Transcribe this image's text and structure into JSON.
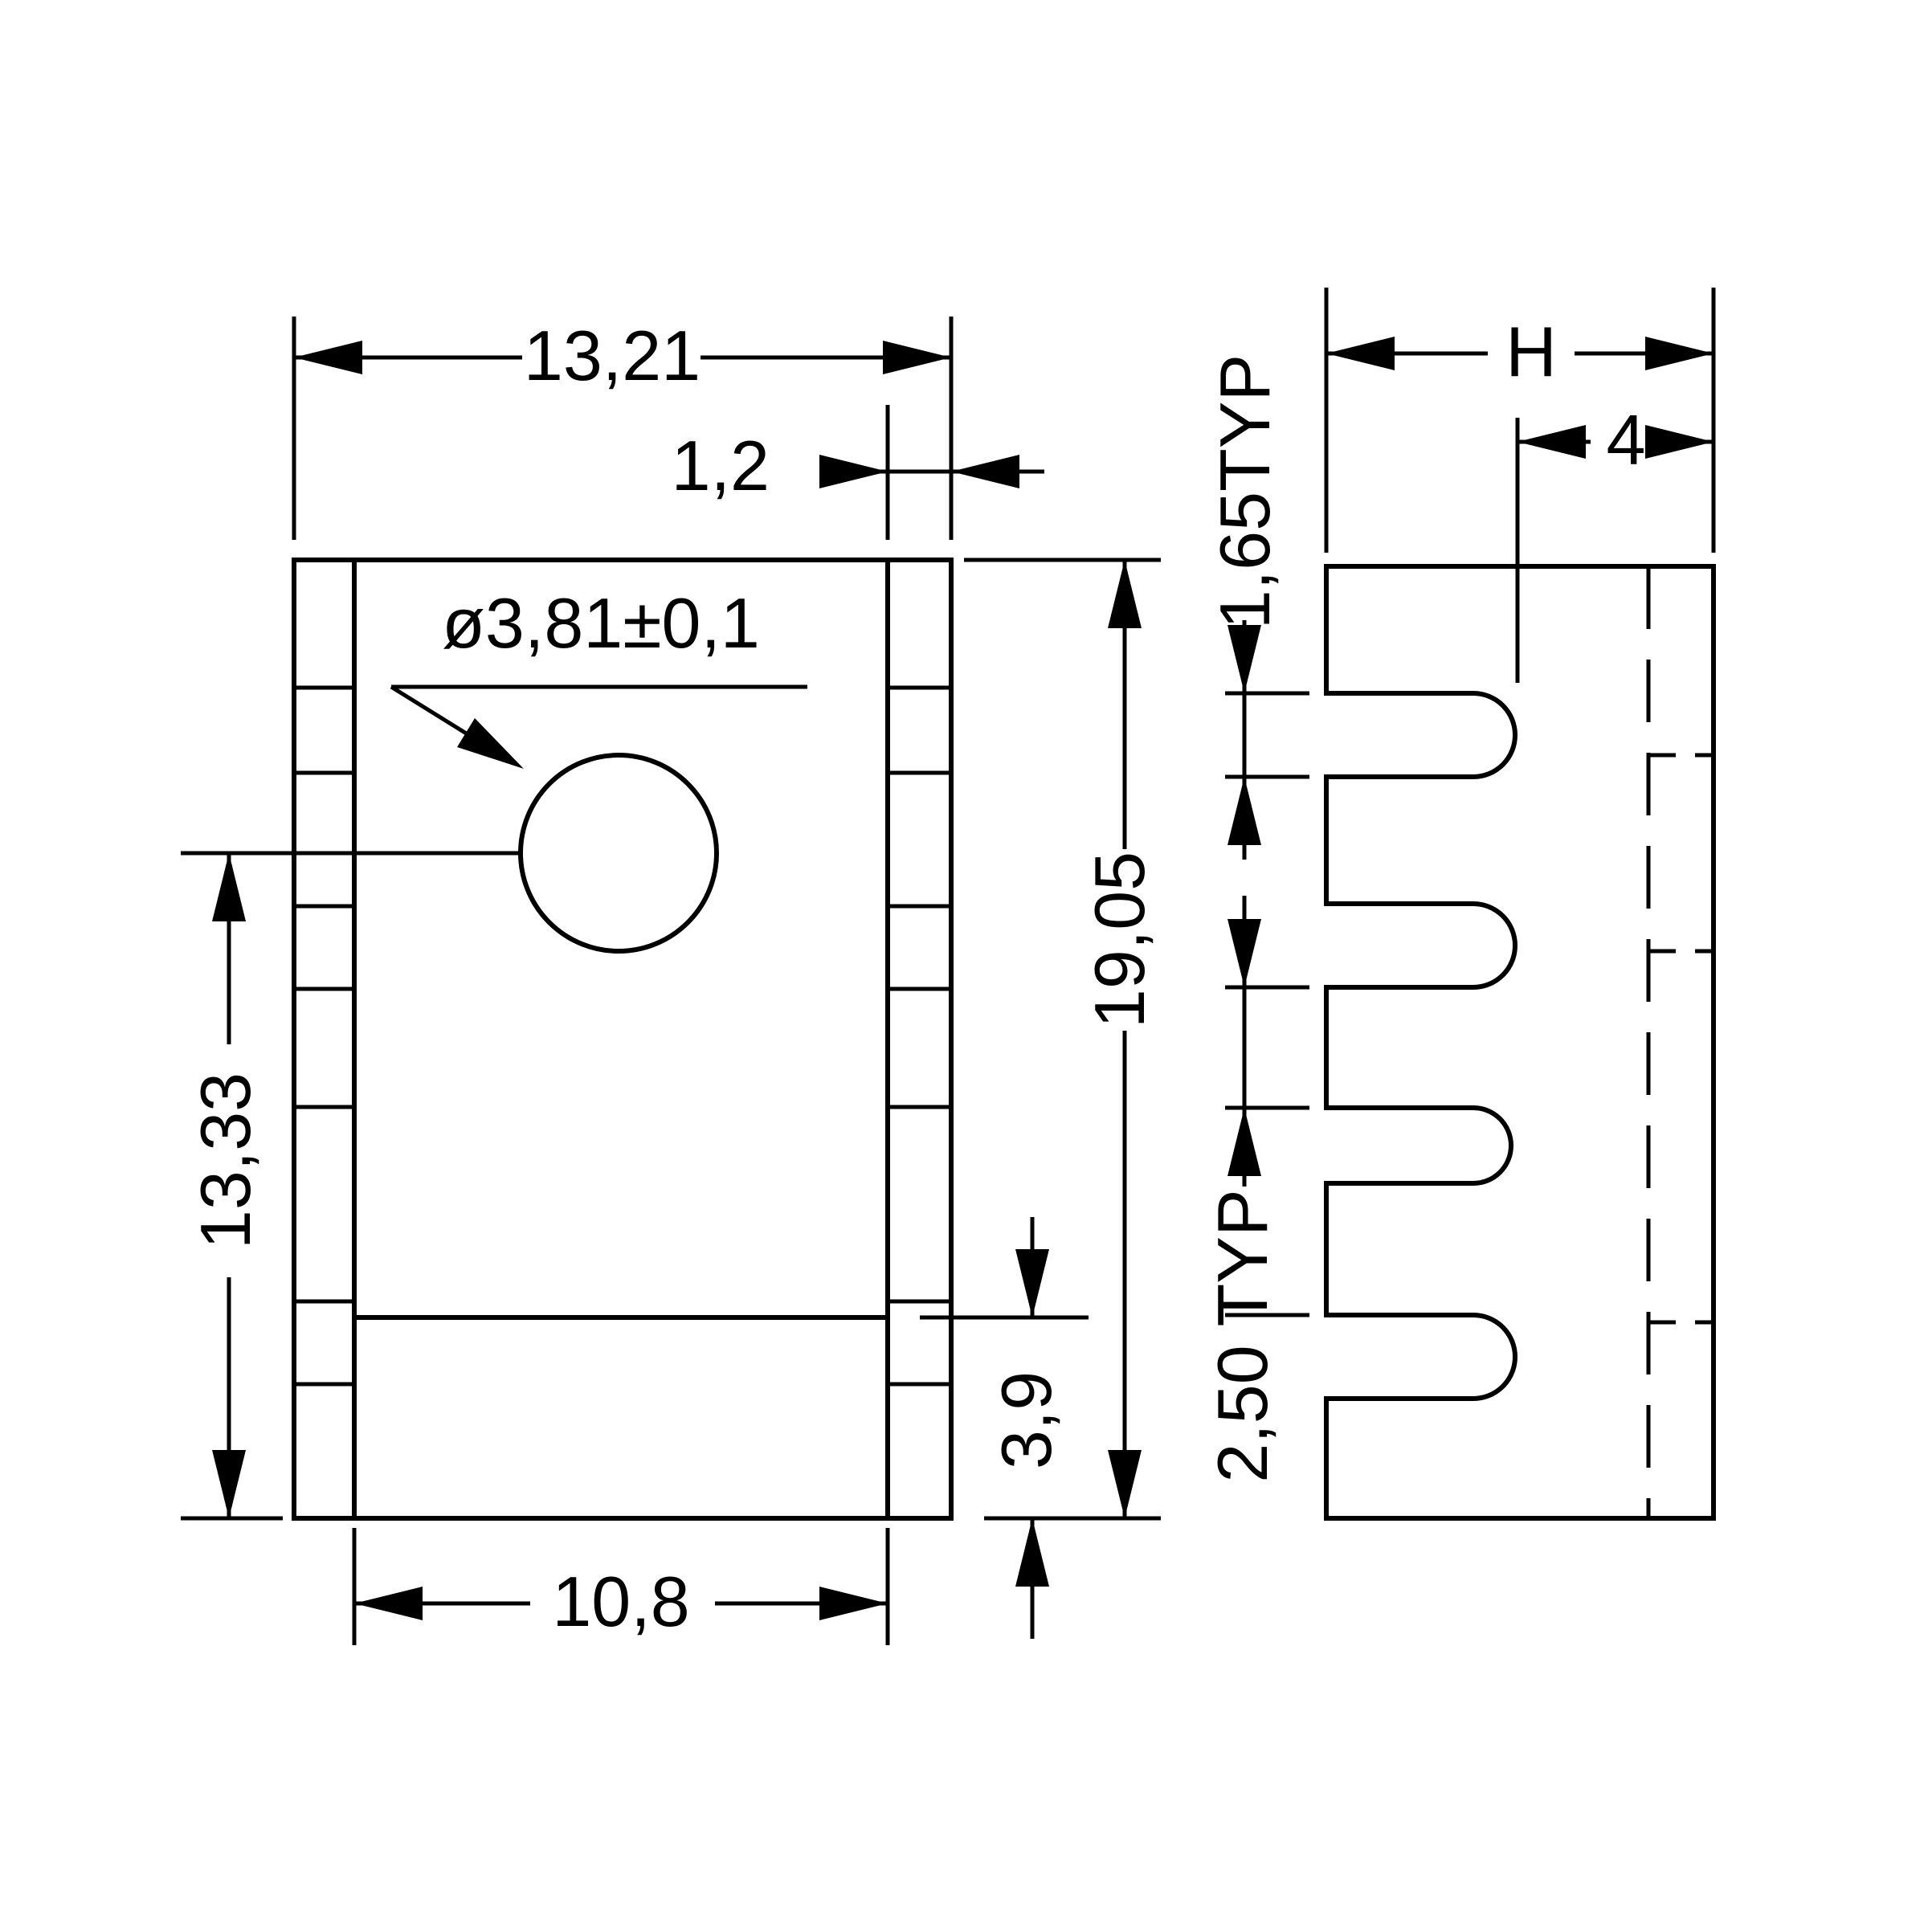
{
  "drawing": {
    "background": "#ffffff",
    "line_color": "#000000",
    "type": "technical-drawing-heatsink",
    "front_view": {
      "dim_width_top": "13,21",
      "dim_plate_thickness": "1,2",
      "hole_callout": "ø3,81±0,1",
      "dim_center_to_bottom": "13,33",
      "dim_total_height": "19,05",
      "dim_step_height": "3,9",
      "dim_width_bottom": "10,8"
    },
    "side_view": {
      "dim_depth": "H",
      "dim_tab_depth": "4",
      "dim_fin_thickness": "1,65TYP",
      "dim_fin_gap": "2,50 TYP"
    }
  }
}
